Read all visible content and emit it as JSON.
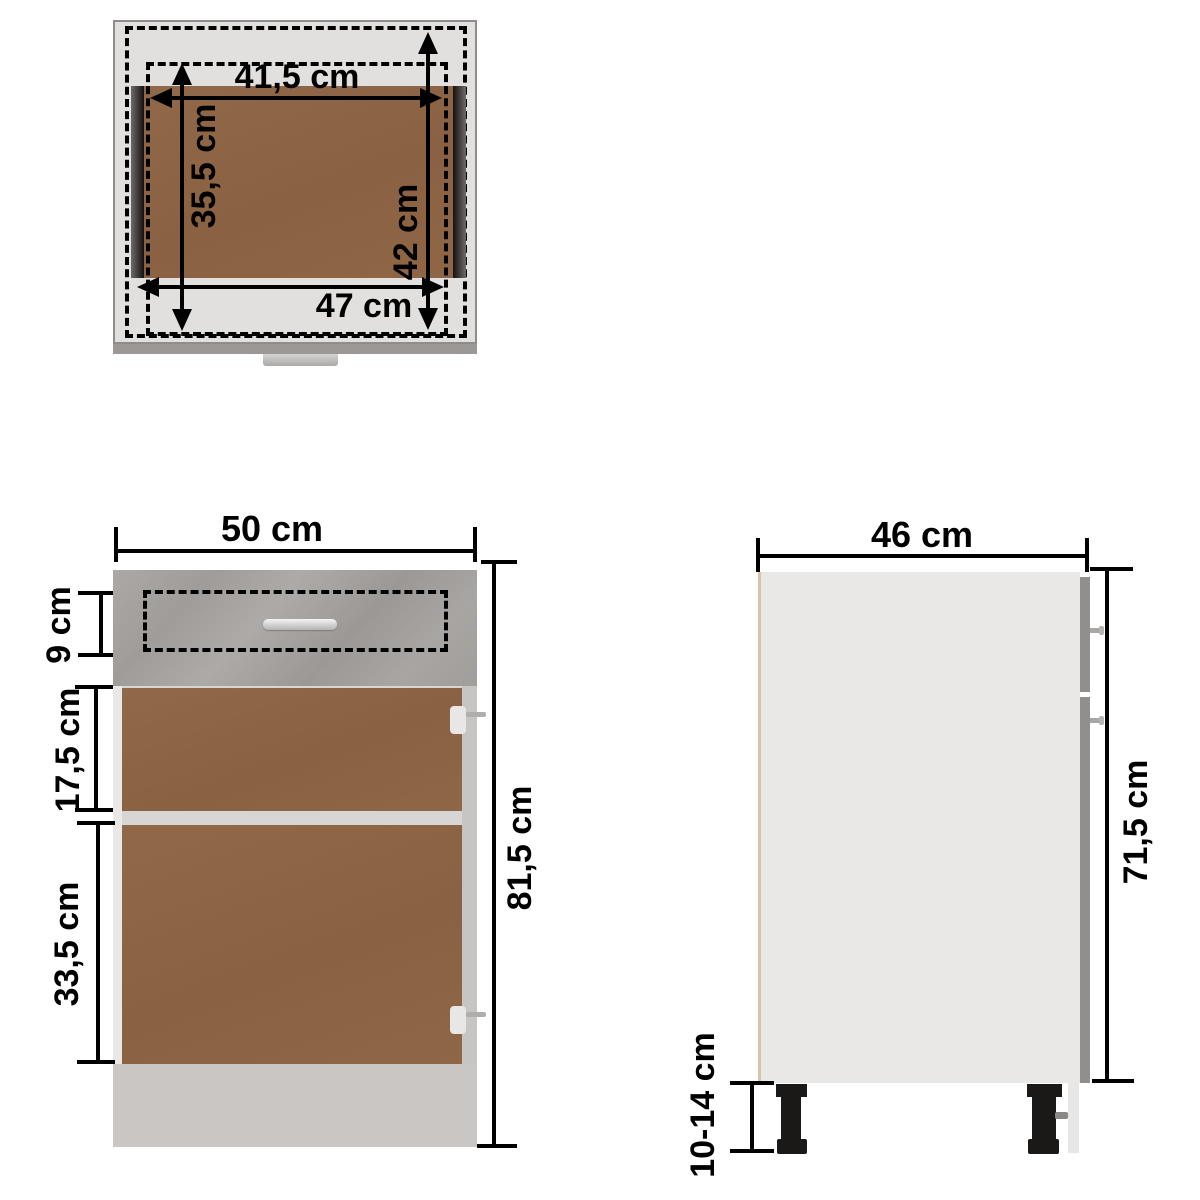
{
  "diagram": {
    "views": {
      "top": {
        "dims": {
          "inner_width": "41,5 cm",
          "inner_depth": "35,5 cm",
          "rail_depth": "42 cm",
          "outer_width": "47 cm"
        }
      },
      "front": {
        "dims": {
          "width": "50 cm",
          "drawer_front_height": "9 cm",
          "upper_section_height": "17,5 cm",
          "lower_section_height": "33,5 cm",
          "total_height": "81,5 cm"
        }
      },
      "side": {
        "dims": {
          "depth": "46 cm",
          "carcass_height": "71,5 cm",
          "leg_height": "10-14 cm"
        }
      }
    },
    "colors": {
      "concrete_gray": "#a8a4a1",
      "wood_brown": "#8d6546",
      "panel_light_gray": "#e2e0de",
      "base_gray": "#c9c6c4",
      "side_body_gray": "#eae8e7",
      "dimension_line": "#000000"
    }
  }
}
